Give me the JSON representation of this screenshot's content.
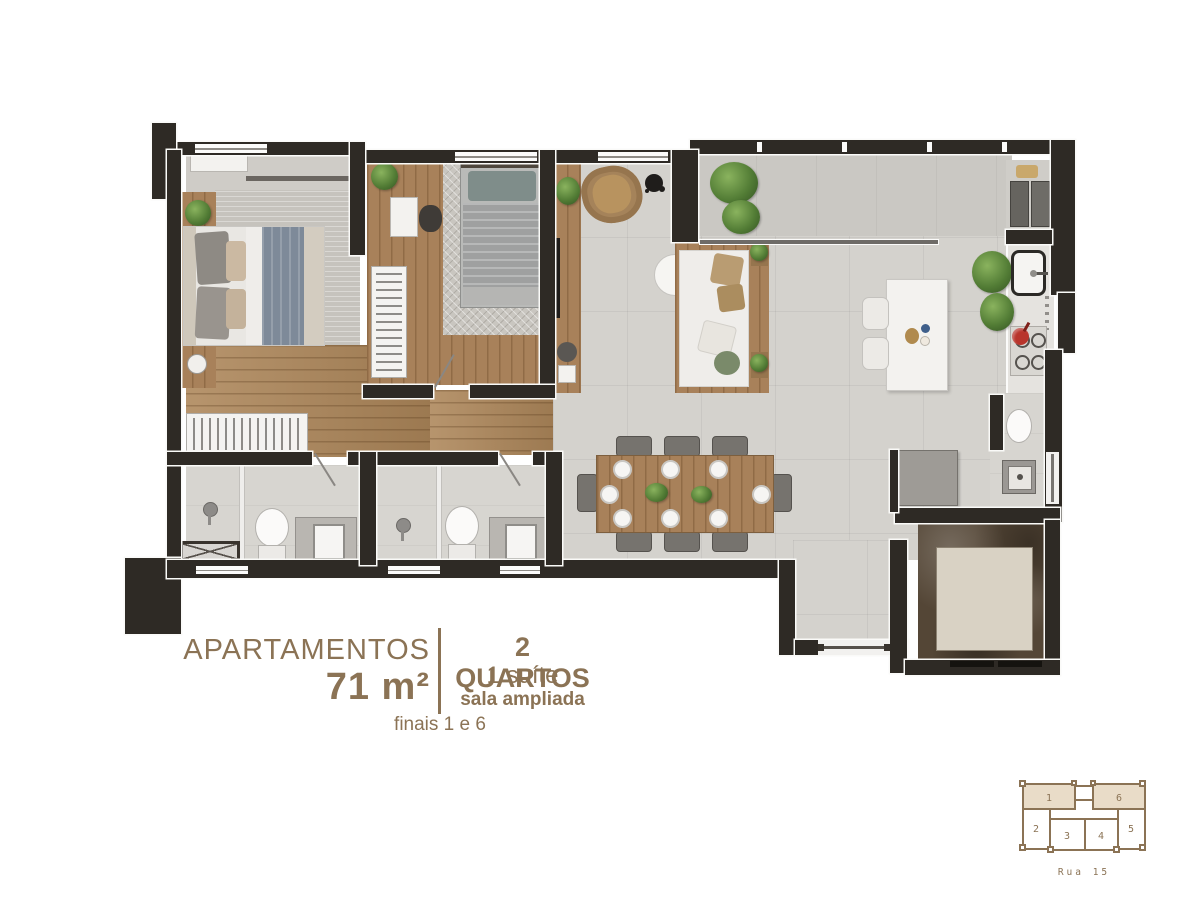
{
  "caption": {
    "left_title": "APARTAMENTOS",
    "left_area": "71 m²",
    "right_line1": "2 QUARTOS",
    "right_line2": "1 suíte",
    "right_line3": "sala ampliada",
    "footnote": "finais 1 e 6"
  },
  "keyplan": {
    "street": "Rua 15",
    "units": [
      {
        "label": "1",
        "highlighted": true
      },
      {
        "label": "2",
        "highlighted": false
      },
      {
        "label": "3",
        "highlighted": false
      },
      {
        "label": "4",
        "highlighted": false
      },
      {
        "label": "5",
        "highlighted": false
      },
      {
        "label": "6",
        "highlighted": true
      }
    ]
  },
  "colors": {
    "accent_brown": "#8b7355",
    "wall_dark": "#2e2a25",
    "floor_gray": "#d4d2cd",
    "wood": "#ad8659",
    "keyplan_highlight_fill": "#e9dcc8",
    "status_red_pot": "#b8352c",
    "plant_green": "#527c35"
  }
}
